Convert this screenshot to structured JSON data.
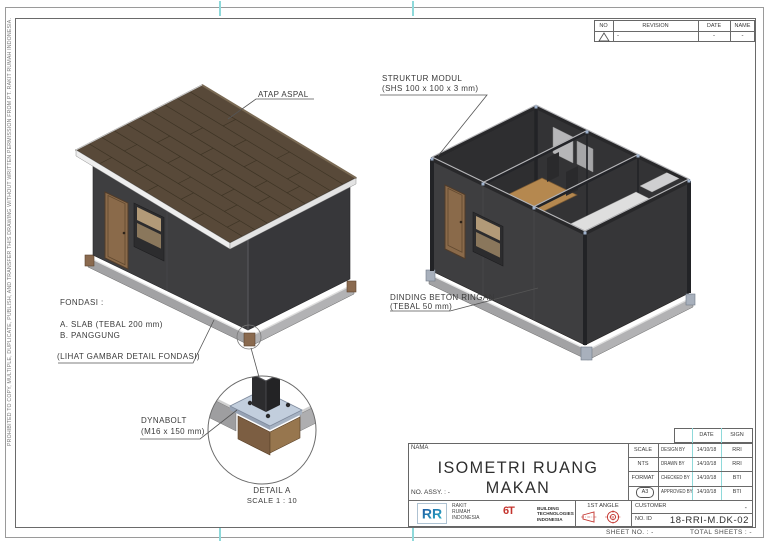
{
  "sheet": {
    "margin_note": "PROHIBITED TO COPY, MULTIPLE, DUPLICATE, PUBLISH, AND TRANSFER THIS DRAWING WITHOUT WRITTEN PERMISSION FROM PT. RAKIT RUMAH INDONESIA.",
    "footer": {
      "sheet_no": "SHEET NO. :  -",
      "total_sheets": "TOTAL SHEETS :  -"
    }
  },
  "palette": {
    "accent_cyan": "#8ed9da",
    "logo_blue": "#1d4f9e",
    "logo_teal": "#2ab5c9",
    "logo_red": "#c4342e",
    "roof_brown": "#584939",
    "wall_dark": "#3e3e40",
    "door_wood": "#8a6a4a",
    "slab_grey": "#a2a2a4",
    "steel_plate": "#c2cedd"
  },
  "revision_table": {
    "headers": [
      "NO",
      "REVISION",
      "DATE",
      "NAME"
    ],
    "row": {
      "revision": "-",
      "date": "-",
      "name": "-"
    }
  },
  "annotations": {
    "atap_aspal": "ATAP ASPAL",
    "struktur_modul_line1": "STRUKTUR MODUL",
    "struktur_modul_line2": "(SHS 100 x 100 x 3 mm)",
    "dinding_line1": "DINDING BETON RINGAN",
    "dinding_line2": "(TEBAL 50 mm)",
    "fondasi_title": "FONDASI :",
    "fondasi_item_a": "A. SLAB (TEBAL 200 mm)",
    "fondasi_item_b": "B. PANGGUNG",
    "fondasi_note": "(LIHAT GAMBAR DETAIL FONDASI)",
    "dynabolt_line1": "DYNABOLT",
    "dynabolt_line2": "(M16 x 150 mm)",
    "detail_title": "DETAIL A",
    "detail_scale": "SCALE 1 : 10"
  },
  "title_block": {
    "nama_label": "NAMA",
    "title": "ISOMETRI RUANG MAKAN",
    "no_assy": "NO. ASSY. :   -",
    "date_header": "DATE",
    "sign_header": "SIGN",
    "scale_label": "SCALE",
    "scale_value": "NTS",
    "format_label": "FORMAT",
    "format_value": "A3",
    "rows": [
      {
        "label": "DESIGN BY",
        "date": "14/10/18",
        "sign": "RRI"
      },
      {
        "label": "DRAWN BY",
        "date": "14/10/18",
        "sign": "RRI"
      },
      {
        "label": "CHECKED BY",
        "date": "14/10/18",
        "sign": "BTI"
      },
      {
        "label": "APPROVED BY",
        "date": "14/10/18",
        "sign": "BTI"
      }
    ],
    "companies": {
      "rri": {
        "mark": "RR",
        "line1": "RAKIT",
        "line2": "RUMAH",
        "line3": "INDONESIA"
      },
      "bti": {
        "mark": "6T",
        "line1": "BUILDING",
        "line2": "TECHNOLOGIES",
        "line3": "INDONESIA"
      }
    },
    "projection_label": "1ST ANGLE",
    "customer_label": "CUSTOMER",
    "customer_value": "-",
    "no_id_label": "NO. ID",
    "drawing_number": "18-RRI-M.DK-02"
  }
}
